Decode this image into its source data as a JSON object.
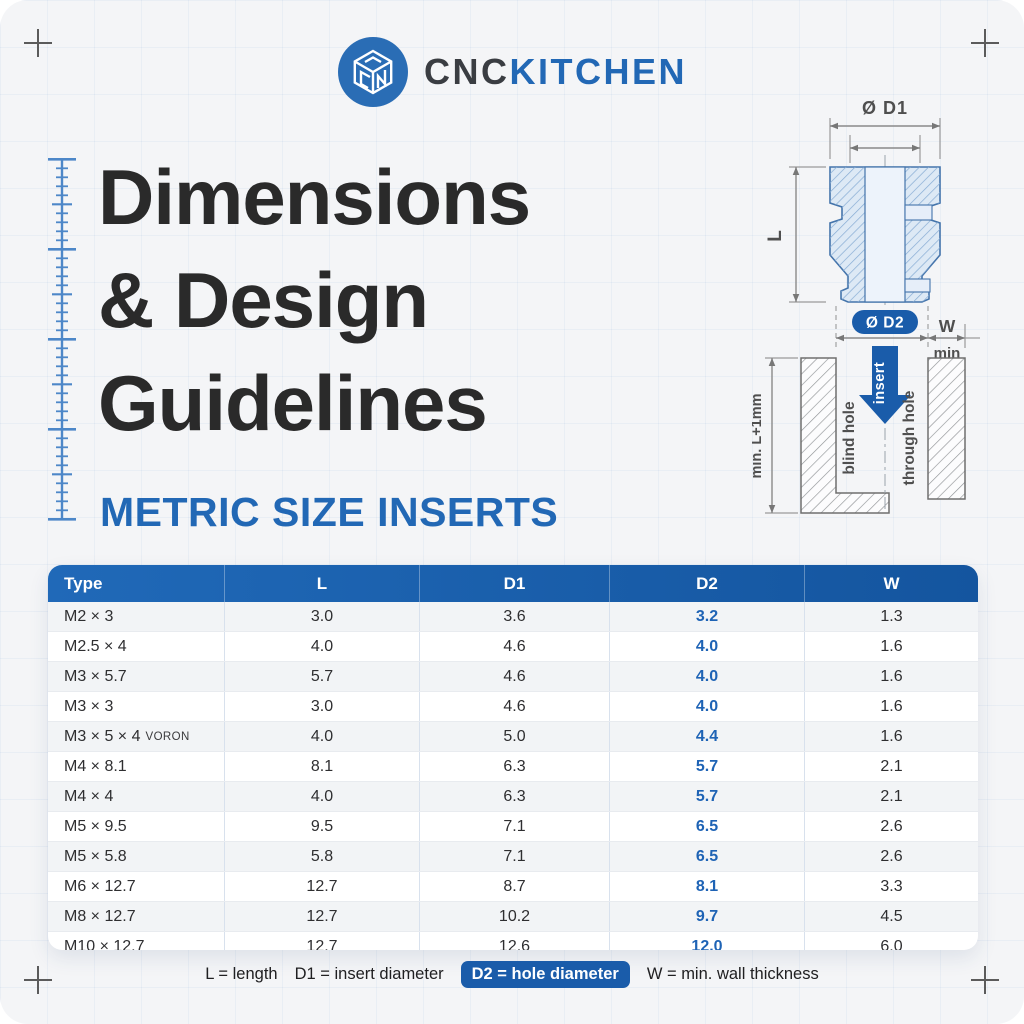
{
  "brand": {
    "cnc": "CNC",
    "kitchen": "KITCHEN"
  },
  "title": {
    "line1": "Dimensions",
    "line2": "& Design",
    "line3": "Guidelines",
    "subtitle": "METRIC SIZE INSERTS"
  },
  "diagram": {
    "d1_label": "Ø D1",
    "l_label": "L",
    "d2_label": "Ø D2",
    "w_label": "W",
    "min_label": "min",
    "insert_label": "insert",
    "blind_hole_label": "blind hole",
    "through_hole_label": "through hole",
    "depth_label": "min. L+1mm"
  },
  "table": {
    "columns": [
      "Type",
      "L",
      "D1",
      "D2",
      "W"
    ],
    "rows": [
      {
        "type": "M2 × 3",
        "l": "3.0",
        "d1": "3.6",
        "d2": "3.2",
        "w": "1.3"
      },
      {
        "type": "M2.5 × 4",
        "l": "4.0",
        "d1": "4.6",
        "d2": "4.0",
        "w": "1.6"
      },
      {
        "type": "M3 × 5.7",
        "l": "5.7",
        "d1": "4.6",
        "d2": "4.0",
        "w": "1.6"
      },
      {
        "type": "M3 × 3",
        "l": "3.0",
        "d1": "4.6",
        "d2": "4.0",
        "w": "1.6"
      },
      {
        "type": "M3 × 5 × 4",
        "suffix": "VORON",
        "l": "4.0",
        "d1": "5.0",
        "d2": "4.4",
        "w": "1.6"
      },
      {
        "type": "M4 × 8.1",
        "l": "8.1",
        "d1": "6.3",
        "d2": "5.7",
        "w": "2.1"
      },
      {
        "type": "M4 × 4",
        "l": "4.0",
        "d1": "6.3",
        "d2": "5.7",
        "w": "2.1"
      },
      {
        "type": "M5 × 9.5",
        "l": "9.5",
        "d1": "7.1",
        "d2": "6.5",
        "w": "2.6"
      },
      {
        "type": "M5 × 5.8",
        "l": "5.8",
        "d1": "7.1",
        "d2": "6.5",
        "w": "2.6"
      },
      {
        "type": "M6 × 12.7",
        "l": "12.7",
        "d1": "8.7",
        "d2": "8.1",
        "w": "3.3"
      },
      {
        "type": "M8 × 12.7",
        "l": "12.7",
        "d1": "10.2",
        "d2": "9.7",
        "w": "4.5"
      },
      {
        "type": "M10 × 12.7",
        "l": "12.7",
        "d1": "12.6",
        "d2": "12.0",
        "w": "6.0"
      }
    ]
  },
  "legend": {
    "l": "L = length",
    "d1": "D1 = insert diameter",
    "d2": "D2 = hole diameter",
    "w": "W = min. wall thickness"
  },
  "colors": {
    "accent_blue": "#1a5caa",
    "header_blue": "#2069b8",
    "d2_value_blue": "#1e63b5",
    "subtitle_blue": "#2268b5",
    "title_dark": "#2a2a2a"
  }
}
